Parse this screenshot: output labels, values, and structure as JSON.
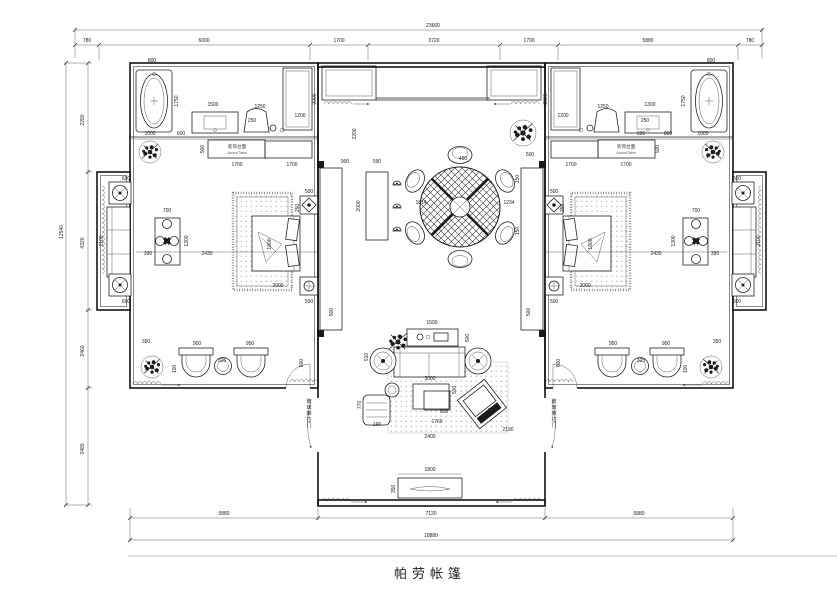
{
  "title": {
    "text": "帕劳帐篷"
  },
  "dimensions": {
    "top": {
      "total": "23660",
      "segments": [
        "780",
        "6000",
        "1700",
        "3720",
        "1700",
        "5880",
        "780"
      ]
    },
    "bottom": {
      "total": "18880",
      "segments": [
        "5880",
        "7120",
        "5880"
      ]
    },
    "left": {
      "total": "12540",
      "segments": [
        "2280",
        "4320",
        "2460",
        "3480"
      ]
    }
  },
  "labels": {
    "accent_table_cn": "装饰台面",
    "accent_table_en": "Accent Table"
  },
  "colors": {
    "line": "#141414",
    "paper": "#ffffff",
    "hatch": "#8a8a8a",
    "stipple": "#b0b0b0"
  },
  "annotations": [
    {
      "t": "800",
      "x": 152,
      "y": 62
    },
    {
      "t": "1750",
      "x": 178,
      "y": 101,
      "r": 1
    },
    {
      "t": "600",
      "x": 181,
      "y": 135
    },
    {
      "t": "1000",
      "x": 150,
      "y": 135
    },
    {
      "t": "1500",
      "x": 213,
      "y": 106
    },
    {
      "t": "250",
      "x": 252,
      "y": 122
    },
    {
      "t": "1250",
      "x": 260,
      "y": 108
    },
    {
      "t": "1200",
      "x": 300,
      "y": 117
    },
    {
      "t": "2000",
      "x": 316,
      "y": 99,
      "r": 1
    },
    {
      "t": "500",
      "x": 204,
      "y": 149,
      "r": 1
    },
    {
      "t": "1700",
      "x": 237,
      "y": 166
    },
    {
      "t": "1700",
      "x": 292,
      "y": 166
    },
    {
      "t": "800",
      "x": 711,
      "y": 62
    },
    {
      "t": "1750",
      "x": 685,
      "y": 101,
      "r": 1
    },
    {
      "t": "250",
      "x": 645,
      "y": 122
    },
    {
      "t": "600",
      "x": 641,
      "y": 135
    },
    {
      "t": "800",
      "x": 668,
      "y": 135
    },
    {
      "t": "1000",
      "x": 703,
      "y": 135
    },
    {
      "t": "1300",
      "x": 650,
      "y": 106
    },
    {
      "t": "1250",
      "x": 603,
      "y": 108
    },
    {
      "t": "1200",
      "x": 563,
      "y": 117
    },
    {
      "t": "2000",
      "x": 547,
      "y": 99,
      "r": 1
    },
    {
      "t": "500",
      "x": 659,
      "y": 149,
      "r": 1
    },
    {
      "t": "1700",
      "x": 571,
      "y": 166
    },
    {
      "t": "1700",
      "x": 626,
      "y": 166
    },
    {
      "t": "600",
      "x": 126,
      "y": 180
    },
    {
      "t": "600",
      "x": 126,
      "y": 303
    },
    {
      "t": "2100",
      "x": 103,
      "y": 241,
      "r": 1
    },
    {
      "t": "700",
      "x": 167,
      "y": 212
    },
    {
      "t": "1300",
      "x": 188,
      "y": 241,
      "r": 1
    },
    {
      "t": "390",
      "x": 148,
      "y": 255
    },
    {
      "t": "2430",
      "x": 207,
      "y": 255
    },
    {
      "t": "600",
      "x": 737,
      "y": 180
    },
    {
      "t": "600",
      "x": 737,
      "y": 303
    },
    {
      "t": "2100",
      "x": 760,
      "y": 241,
      "r": 1
    },
    {
      "t": "700",
      "x": 696,
      "y": 212
    },
    {
      "t": "1300",
      "x": 675,
      "y": 241,
      "r": 1
    },
    {
      "t": "390",
      "x": 715,
      "y": 255
    },
    {
      "t": "2430",
      "x": 656,
      "y": 255
    },
    {
      "t": "500",
      "x": 309,
      "y": 193
    },
    {
      "t": "250",
      "x": 299,
      "y": 208,
      "r": 1
    },
    {
      "t": "1800",
      "x": 271,
      "y": 244,
      "r": 1
    },
    {
      "t": "2000",
      "x": 278,
      "y": 287
    },
    {
      "t": "500",
      "x": 309,
      "y": 303
    },
    {
      "t": "500",
      "x": 333,
      "y": 312,
      "r": 1
    },
    {
      "t": "500",
      "x": 554,
      "y": 193
    },
    {
      "t": "250",
      "x": 564,
      "y": 208,
      "r": 1
    },
    {
      "t": "1800",
      "x": 592,
      "y": 244,
      "r": 1
    },
    {
      "t": "2000",
      "x": 585,
      "y": 287
    },
    {
      "t": "500",
      "x": 554,
      "y": 303
    },
    {
      "t": "500",
      "x": 530,
      "y": 312,
      "r": 1
    },
    {
      "t": "2200",
      "x": 356,
      "y": 134,
      "r": 1
    },
    {
      "t": "900",
      "x": 345,
      "y": 163
    },
    {
      "t": "590",
      "x": 377,
      "y": 163
    },
    {
      "t": "500",
      "x": 530,
      "y": 156
    },
    {
      "t": "2000",
      "x": 360,
      "y": 206,
      "r": 1
    },
    {
      "t": "1814",
      "x": 421,
      "y": 204
    },
    {
      "t": "450",
      "x": 463,
      "y": 160
    },
    {
      "t": "1234",
      "x": 509,
      "y": 204
    },
    {
      "t": "150",
      "x": 519,
      "y": 179,
      "r": 1
    },
    {
      "t": "150",
      "x": 519,
      "y": 231,
      "r": 1
    },
    {
      "t": "1500",
      "x": 432,
      "y": 324
    },
    {
      "t": "500",
      "x": 469,
      "y": 338,
      "r": 1
    },
    {
      "t": "510",
      "x": 368,
      "y": 357,
      "r": 1
    },
    {
      "t": "3000",
      "x": 430,
      "y": 380
    },
    {
      "t": "500",
      "x": 456,
      "y": 390,
      "r": 1
    },
    {
      "t": "770",
      "x": 361,
      "y": 405,
      "r": 1
    },
    {
      "t": "190",
      "x": 377,
      "y": 426
    },
    {
      "t": "500",
      "x": 444,
      "y": 413
    },
    {
      "t": "1760",
      "x": 437,
      "y": 423
    },
    {
      "t": "950",
      "x": 492,
      "y": 412
    },
    {
      "t": "2190",
      "x": 508,
      "y": 431
    },
    {
      "t": "2400",
      "x": 430,
      "y": 438
    },
    {
      "t": "1800",
      "x": 430,
      "y": 471
    },
    {
      "t": "350",
      "x": 395,
      "y": 489,
      "r": 1
    },
    {
      "t": "350",
      "x": 146,
      "y": 343
    },
    {
      "t": "900",
      "x": 197,
      "y": 345
    },
    {
      "t": "950",
      "x": 250,
      "y": 345
    },
    {
      "t": "325",
      "x": 222,
      "y": 362
    },
    {
      "t": "100",
      "x": 176,
      "y": 369,
      "r": 1
    },
    {
      "t": "600",
      "x": 303,
      "y": 363,
      "r": 1
    },
    {
      "t": "350",
      "x": 717,
      "y": 343
    },
    {
      "t": "900",
      "x": 666,
      "y": 345
    },
    {
      "t": "950",
      "x": 613,
      "y": 345
    },
    {
      "t": "325",
      "x": 641,
      "y": 362
    },
    {
      "t": "100",
      "x": 687,
      "y": 369,
      "r": 1
    },
    {
      "t": "600",
      "x": 560,
      "y": 363,
      "r": 1
    },
    {
      "t": "玻璃推拉门",
      "x": 309,
      "y": 403,
      "v": 1
    },
    {
      "t": "玻璃推拉门",
      "x": 554,
      "y": 403,
      "v": 1
    }
  ]
}
